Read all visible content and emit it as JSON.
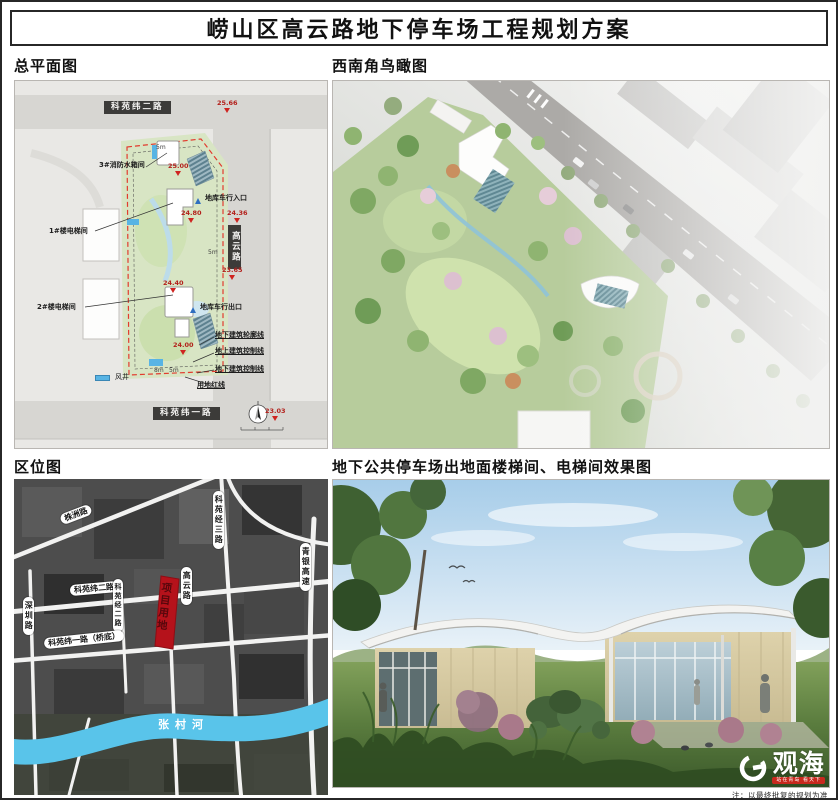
{
  "title": "崂山区高云路地下停车场工程规划方案",
  "note": "注：以最终批复的规划为准",
  "sections": {
    "site_plan_label": "总平面图",
    "aerial_label": "西南角鸟瞰图",
    "location_label": "区位图",
    "render_label": "地下公共停车场出地面楼梯间、电梯间效果图"
  },
  "site_plan": {
    "roads": {
      "top": "科苑纬二路",
      "bottom": "科苑纬一路",
      "right": "高云路"
    },
    "callouts": {
      "fire_tank": "3#消防水箱间",
      "elevator1": "1#楼电梯间",
      "elevator2": "2#楼电梯间",
      "entrance": "地库车行入口",
      "exit": "地库车行出口",
      "outline_underground": "地下建筑轮廓线",
      "control_above_ground": "地上建筑控制线",
      "control_underground": "地下建筑控制线",
      "red_line": "用地红线"
    },
    "legend": {
      "wind_shaft": "风井"
    },
    "elevations": {
      "ne": "25.66",
      "tank": "25.00",
      "entrance_site": "24.80",
      "entrance_road": "24.36",
      "road_mid": "23.65",
      "exit_site": "24.40",
      "south_site": "24.00",
      "sw": "23.03"
    },
    "dims": {
      "top": "5m",
      "road": "5m",
      "bottom_a": "8m",
      "bottom_b": "5m"
    }
  },
  "location_map": {
    "roads": {
      "zhuzhou": "株洲路",
      "keyuan_jing_3": "科苑经三路",
      "qingyin_expwy": "青银高速",
      "keyuan_wei_2": "科苑纬二路",
      "keyuan_jing_2": "科苑经二路",
      "gaoyun": "高云路",
      "shenzhen": "深圳路",
      "keyuan_wei_1": "科苑纬一路（桥底）"
    },
    "river": "张村河",
    "project_site": "项目用地"
  },
  "logo": {
    "name": "观海",
    "tagline": "站在青岛 看天下"
  },
  "colors": {
    "boundary_red": "#e23b2e",
    "project_red": "#b5121b",
    "river_blue": "#59c4ea",
    "wind_shaft_blue": "#58b4e4"
  }
}
